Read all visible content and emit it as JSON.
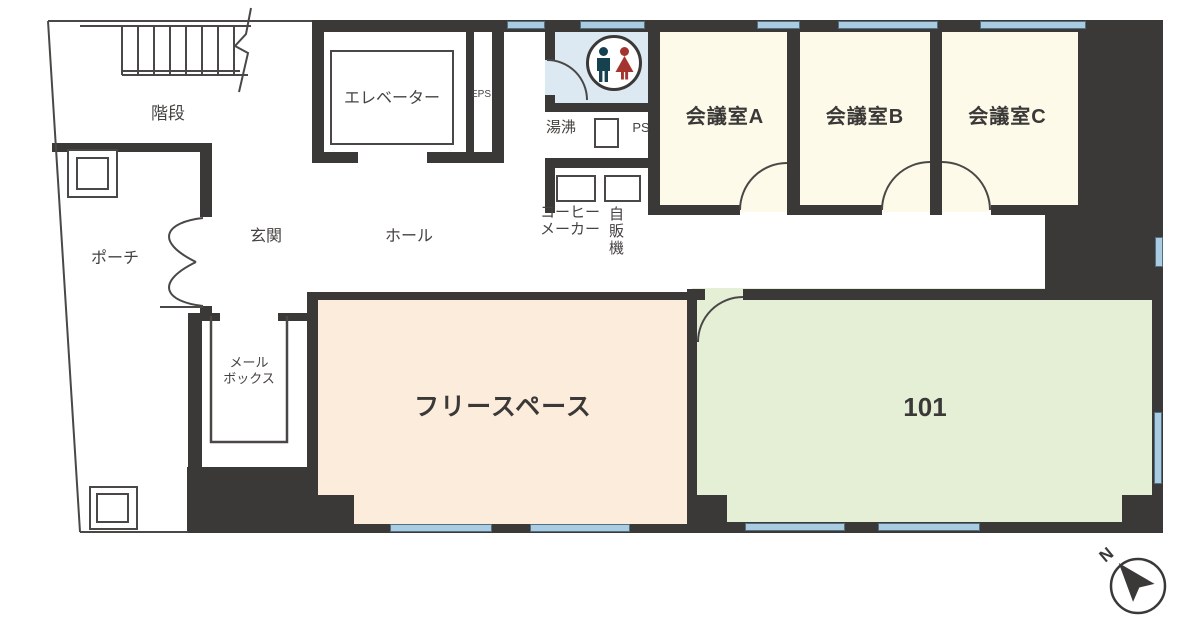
{
  "plan": {
    "rooms": {
      "stairs": "階段",
      "elevator": "エレベーター",
      "eps": "EPS",
      "kettle": "湯沸",
      "ps": "PS",
      "coffee_maker": "コーヒー\nメーカー",
      "vending_machine": "自販機",
      "meeting_a": "会議室A",
      "meeting_b": "会議室B",
      "meeting_c": "会議室C",
      "entrance": "玄関",
      "hall": "ホール",
      "porch": "ポーチ",
      "mailbox": "メール\nボックス",
      "free_space": "フリースペース",
      "room_101": "101"
    },
    "compass": {
      "north": "N"
    },
    "colors": {
      "wall": "#3b3937",
      "line": "#4a4846",
      "text": "#45423f",
      "meeting": "#fdfae9",
      "freespace": "#fcecdc",
      "room101": "#e5efd6",
      "toilet": "#dce9f3",
      "window": "#a9cce3",
      "male": "#16414f",
      "female": "#a5342f"
    }
  }
}
